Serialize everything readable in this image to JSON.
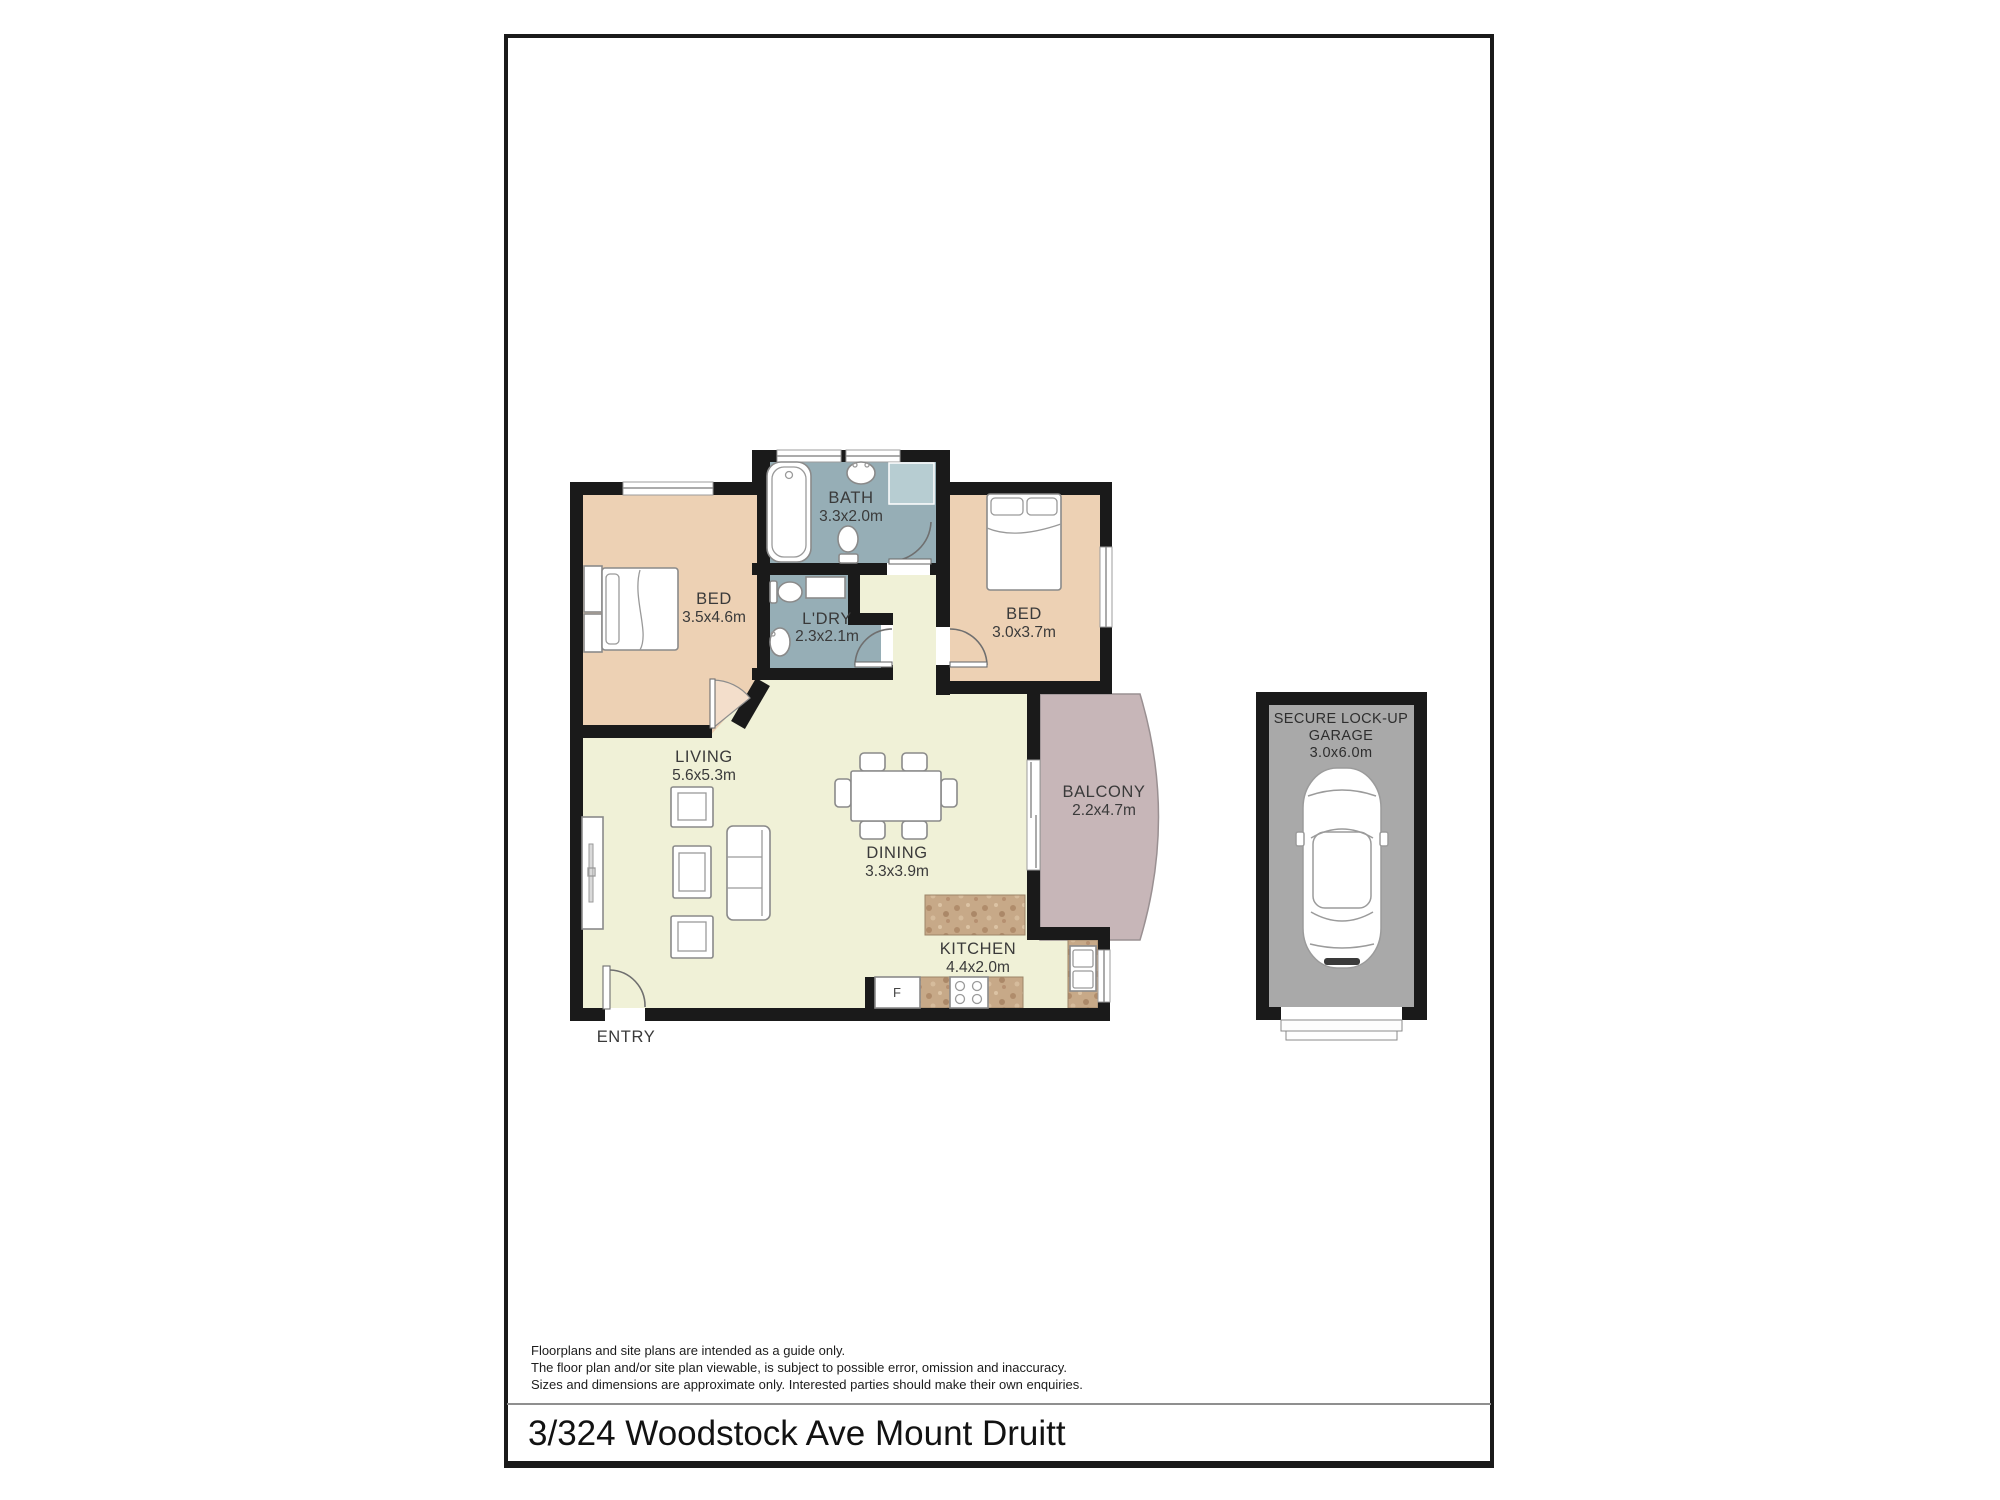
{
  "page": {
    "title": "3/324 Woodstock Ave Mount Druitt",
    "disclaimer_line1": "Floorplans and site plans are intended as a guide only.",
    "disclaimer_line2": "The floor plan and/or site plan viewable, is subject to possible error, omission and inaccuracy.",
    "disclaimer_line3": "Sizes and dimensions are approximate only. Interested parties should make their own enquiries."
  },
  "floorplan": {
    "rooms": [
      {
        "label": "BATH",
        "dims": "3.3x2.0m"
      },
      {
        "label": "BED",
        "dims": "3.5x4.6m"
      },
      {
        "label": "L'DRY",
        "dims": "2.3x2.1m"
      },
      {
        "label": "BED",
        "dims": "3.0x3.7m"
      },
      {
        "label": "LIVING",
        "dims": "5.6x5.3m"
      },
      {
        "label": "DINING",
        "dims": "3.3x3.9m"
      },
      {
        "label": "BALCONY",
        "dims": "2.2x4.7m"
      },
      {
        "label": "KITCHEN",
        "dims": "4.4x2.0m"
      }
    ],
    "entry_label": "ENTRY",
    "fridge_label": "F",
    "garage": {
      "line1": "SECURE LOCK-UP",
      "line2": "GARAGE",
      "dims": "3.0x6.0m"
    }
  },
  "colors": {
    "wall": "#1a1a1a",
    "bedroom_fill": "#edd1b4",
    "wet_area_fill": "#96aeb6",
    "living_fill": "#f0f1d7",
    "balcony_fill": "#c7b6b8",
    "counter_fill": "#c7a988",
    "garage_fill": "#a9a9a9",
    "vanity_fill": "#b7cdd2"
  }
}
